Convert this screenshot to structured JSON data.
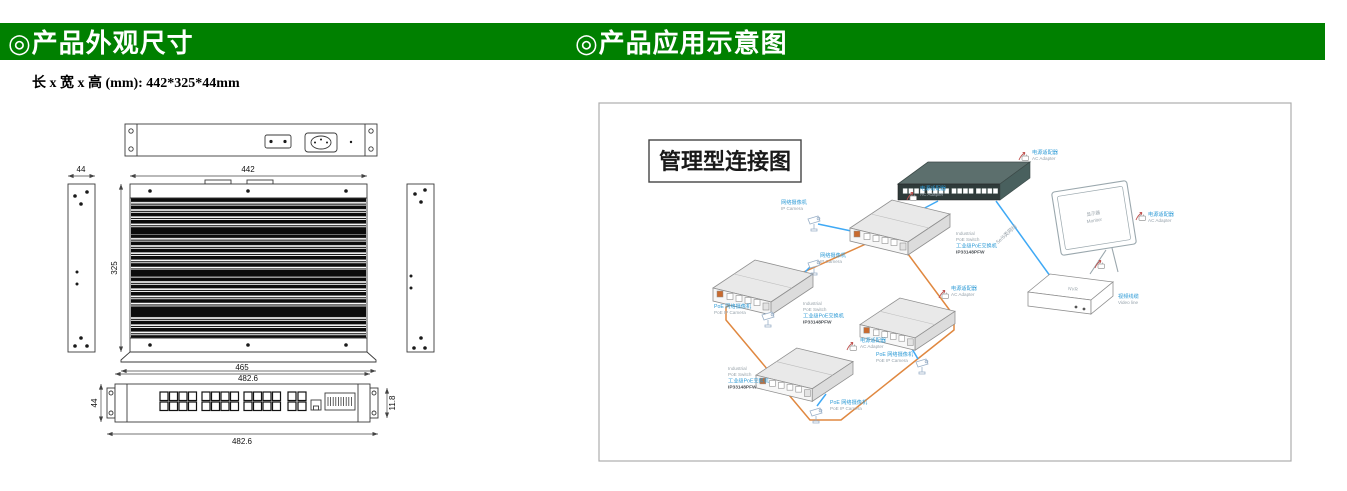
{
  "header": {
    "left_title": "◎产品外观尺寸",
    "right_title": "◎产品应用示意图"
  },
  "colors": {
    "header_green": "#008000",
    "fiber_ring_orange": "#E08840",
    "ethernet_blue": "#3FA9F5",
    "label_blue": "#2E9BD6"
  },
  "dimensions": {
    "subtitle": "长 x 宽 x 高 (mm): 442*325*44mm",
    "top_view_width": "442",
    "top_view_depth": "325",
    "side_view_width": "44",
    "base_width": "482.6",
    "front_view_width": "465",
    "front_view_height": "44",
    "front_base_width": "482.6",
    "ear_depth": "11.8"
  },
  "application": {
    "diagram_title": "管理型连接图",
    "monitor_label_cn": "显示器",
    "monitor_label_en": "Monitor",
    "nvr_label": "NVR",
    "video_line_cn": "视频线缆",
    "video_line_en": "Video line",
    "cat_cable": "5e/6类网线",
    "ac_adapter_cn": "电源适配器",
    "ac_adapter_en": "AC Adapter",
    "ip_camera_cn": "网络摄像机",
    "ip_camera_en": "IP Camera",
    "poe_camera_cn": "PoE 网络摄像机",
    "poe_camera_en": "PoE IP Camera",
    "switch_en1": "Industrial",
    "switch_en2": "PoE Switch",
    "switch_cn": "工业级PoE交换机",
    "switch_model": "IP33148PFW"
  }
}
